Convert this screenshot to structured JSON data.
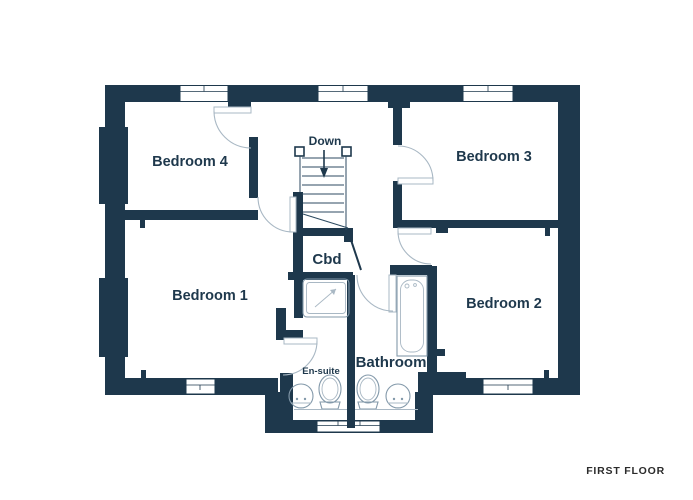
{
  "floor": {
    "title": "FIRST FLOOR"
  },
  "rooms": {
    "bedroom4": {
      "label": "Bedroom 4"
    },
    "bedroom3": {
      "label": "Bedroom 3"
    },
    "bedroom1": {
      "label": "Bedroom 1"
    },
    "bedroom2": {
      "label": "Bedroom 2"
    },
    "bathroom": {
      "label": "Bathroom"
    },
    "ensuite": {
      "label": "En-suite"
    },
    "cupboard": {
      "label": "Cbd"
    }
  },
  "stairs": {
    "label": "Down",
    "direction": "down-arrow"
  },
  "fixtures": [
    "stairs",
    "shower-tray",
    "bath",
    "toilet",
    "basin",
    "counter"
  ],
  "colors": {
    "wall": "#1e384c",
    "door_arc": "#a9b8c4",
    "fixture_line": "#8399aa",
    "room_text": "#1e384c",
    "floor_title_text": "#2b2b2b",
    "background": "#ffffff"
  }
}
